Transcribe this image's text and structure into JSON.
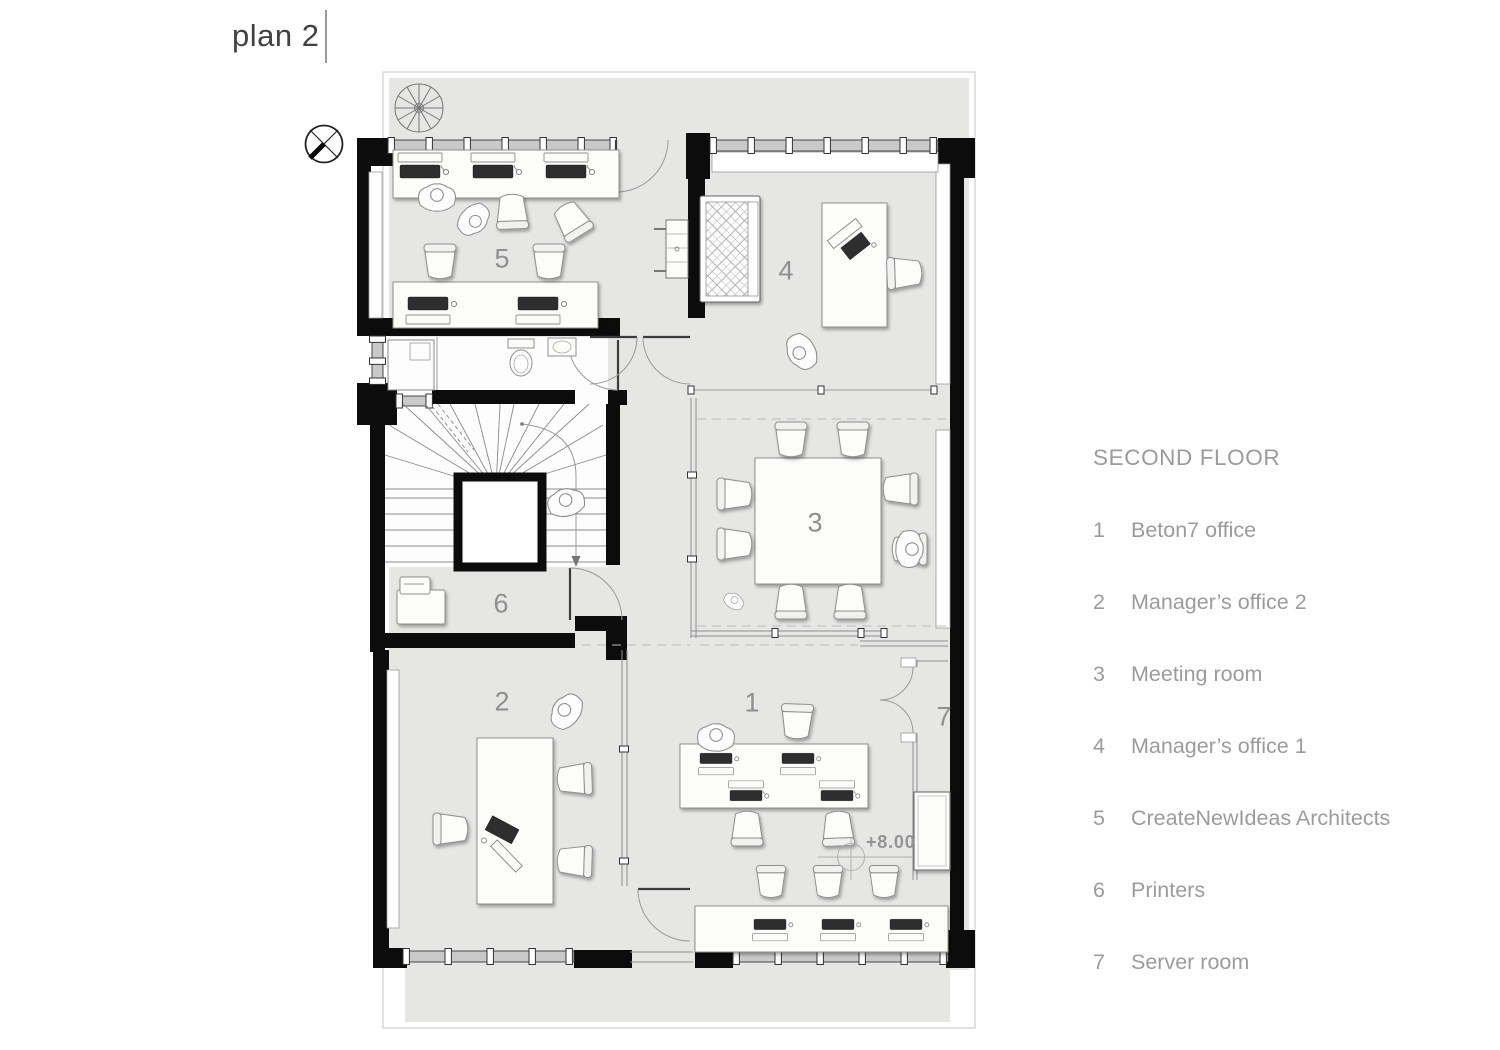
{
  "title": "plan 2",
  "legend": {
    "heading": "SECOND FLOOR",
    "items": [
      {
        "number": "1",
        "label": "Beton7 office"
      },
      {
        "number": "2",
        "label": "Manager’s office 2"
      },
      {
        "number": "3",
        "label": "Meeting room"
      },
      {
        "number": "4",
        "label": "Manager’s office 1"
      },
      {
        "number": "5",
        "label": "CreateNewIdeas Architects"
      },
      {
        "number": "6",
        "label": "Printers"
      },
      {
        "number": "7",
        "label": "Server room"
      }
    ]
  },
  "plan": {
    "room_labels": {
      "beton7_office": "1",
      "managers_office_2": "2",
      "meeting_room": "3",
      "managers_office_1": "4",
      "createnewideas_architects": "5",
      "printers": "6",
      "server_room": "7"
    },
    "level_marker": "+8.00"
  },
  "colors": {
    "wall": "#0c0c0c",
    "sheet": "#e6e6e5",
    "text_gray": "#9a9a9a",
    "furniture": "#fcfcfb",
    "device_dark": "#2e2e2e"
  }
}
